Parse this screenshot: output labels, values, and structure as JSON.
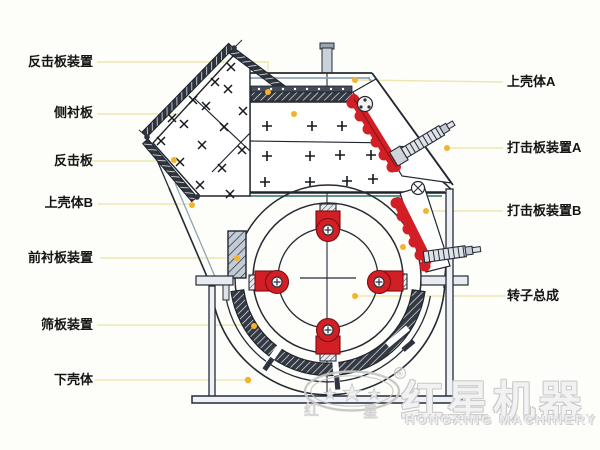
{
  "labels": {
    "left": [
      {
        "text": "反击板装置"
      },
      {
        "text": "侧衬板"
      },
      {
        "text": "反击板"
      },
      {
        "text": "上壳体B"
      },
      {
        "text": "前衬板装置"
      },
      {
        "text": "筛板装置"
      },
      {
        "text": "下壳体"
      }
    ],
    "right": [
      {
        "text": "上壳体A"
      },
      {
        "text": "打击板装置A"
      },
      {
        "text": "打击板装置B"
      },
      {
        "text": "转子总成"
      }
    ]
  },
  "watermark": {
    "cn_char_left": "红",
    "cn_char_right": "星",
    "brand_cn": "红星机器",
    "brand_en": "HONGXING MACHINERY",
    "registered_mark": "®"
  },
  "colors": {
    "line": "#252b36",
    "casing_accent": "#8fa3b8",
    "red_part": "#d21f26",
    "leader_line": "#ece6b2",
    "marker_dot": "#f4b32a",
    "watermark_gray": "#c9c9c9"
  }
}
